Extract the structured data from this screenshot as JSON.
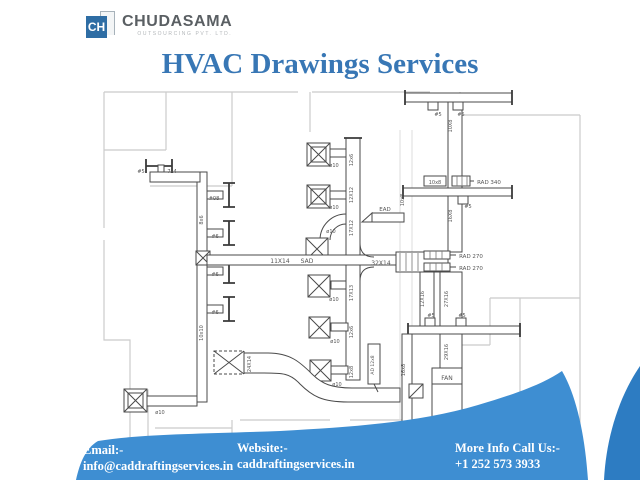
{
  "brand": {
    "mark": "CH",
    "name": "CHUDASAMA",
    "tagline": "OUTSOURCING PVT. LTD."
  },
  "title": "HVAC Drawings Services",
  "footer": {
    "email_label": "Email:-",
    "email": "info@caddraftingservices.in",
    "website_label": "Website:-",
    "website": "caddraftingservices.in",
    "call_label": "More Info Call Us:-",
    "phone": "+1 252 573 3933"
  },
  "colors": {
    "wave_blue": "#3e8ed2",
    "wave_corner_blue": "#2d7cc2",
    "title_blue": "#3877b5",
    "logo_blue": "#2e6da4",
    "wall_gray": "#cbcbcb",
    "duct_gray": "#4a4a4a"
  },
  "drawing": {
    "type": "hvac-duct-floor-plan",
    "labels": [
      {
        "t": "#5",
        "x": 141,
        "y": 173,
        "s": 5
      },
      {
        "t": "7x4",
        "x": 172,
        "y": 173,
        "s": 5
      },
      {
        "t": "#08",
        "x": 214,
        "y": 200,
        "s": 5
      },
      {
        "t": "8x6",
        "x": 203,
        "y": 220,
        "s": 5,
        "r": -90
      },
      {
        "t": "#6",
        "x": 215,
        "y": 238,
        "s": 5
      },
      {
        "t": "#6",
        "x": 215,
        "y": 276,
        "s": 5
      },
      {
        "t": "#6",
        "x": 215,
        "y": 314,
        "s": 5
      },
      {
        "t": "10x10",
        "x": 203,
        "y": 333,
        "s": 5,
        "r": -90
      },
      {
        "t": "ø10",
        "x": 160,
        "y": 414,
        "s": 5
      },
      {
        "t": "11X14",
        "x": 280,
        "y": 263,
        "s": 6
      },
      {
        "t": "SAD",
        "x": 307,
        "y": 263,
        "s": 6
      },
      {
        "t": "32X14",
        "x": 381,
        "y": 265,
        "s": 6
      },
      {
        "t": "ø10",
        "x": 334,
        "y": 167,
        "s": 5
      },
      {
        "t": "ø10",
        "x": 334,
        "y": 209,
        "s": 5
      },
      {
        "t": "ø10",
        "x": 331,
        "y": 233,
        "s": 5
      },
      {
        "t": "12x6",
        "x": 353,
        "y": 160,
        "s": 5,
        "r": -90
      },
      {
        "t": "12X12",
        "x": 353,
        "y": 195,
        "s": 5,
        "r": -90
      },
      {
        "t": "17X12",
        "x": 353,
        "y": 228,
        "s": 5,
        "r": -90
      },
      {
        "t": "17X13",
        "x": 353,
        "y": 293,
        "s": 5,
        "r": -90
      },
      {
        "t": "ø10",
        "x": 334,
        "y": 301,
        "s": 5
      },
      {
        "t": "ø10",
        "x": 335,
        "y": 343,
        "s": 5
      },
      {
        "t": "ø10",
        "x": 337,
        "y": 386,
        "s": 5
      },
      {
        "t": "12x6",
        "x": 353,
        "y": 332,
        "s": 5,
        "r": -90
      },
      {
        "t": "12x8",
        "x": 353,
        "y": 372,
        "s": 5,
        "r": -90
      },
      {
        "t": "AD 12x8",
        "x": 374,
        "y": 365,
        "s": 4.5,
        "r": -90
      },
      {
        "t": "EAD",
        "x": 385,
        "y": 211,
        "s": 5.5
      },
      {
        "t": "10x8",
        "x": 404,
        "y": 200,
        "s": 5,
        "r": -90
      },
      {
        "t": "#5",
        "x": 438,
        "y": 116,
        "s": 5
      },
      {
        "t": "#5",
        "x": 461,
        "y": 116,
        "s": 5
      },
      {
        "t": "10X8",
        "x": 452,
        "y": 126,
        "s": 5,
        "r": -90
      },
      {
        "t": "10x8",
        "x": 435,
        "y": 184,
        "s": 5
      },
      {
        "t": "RAD 340",
        "x": 489,
        "y": 184,
        "s": 5.5
      },
      {
        "t": "16X8",
        "x": 452,
        "y": 216,
        "s": 5,
        "r": -90
      },
      {
        "t": "#5",
        "x": 468,
        "y": 208,
        "s": 5
      },
      {
        "t": "RAD 270",
        "x": 471,
        "y": 258,
        "s": 5.5
      },
      {
        "t": "RAD 270",
        "x": 471,
        "y": 270,
        "s": 5.5
      },
      {
        "t": "12X16",
        "x": 424,
        "y": 299,
        "s": 5,
        "r": -90
      },
      {
        "t": "27X16",
        "x": 448,
        "y": 299,
        "s": 5,
        "r": -90
      },
      {
        "t": "#5",
        "x": 431,
        "y": 317,
        "s": 5
      },
      {
        "t": "#5",
        "x": 462,
        "y": 317,
        "s": 5
      },
      {
        "t": "16x8",
        "x": 405,
        "y": 370,
        "s": 5,
        "r": -90
      },
      {
        "t": "29X16",
        "x": 448,
        "y": 352,
        "s": 5,
        "r": -90
      },
      {
        "t": "FAN",
        "x": 447,
        "y": 380,
        "s": 6
      },
      {
        "t": "24X14",
        "x": 251,
        "y": 364,
        "s": 5,
        "r": -90
      }
    ]
  }
}
